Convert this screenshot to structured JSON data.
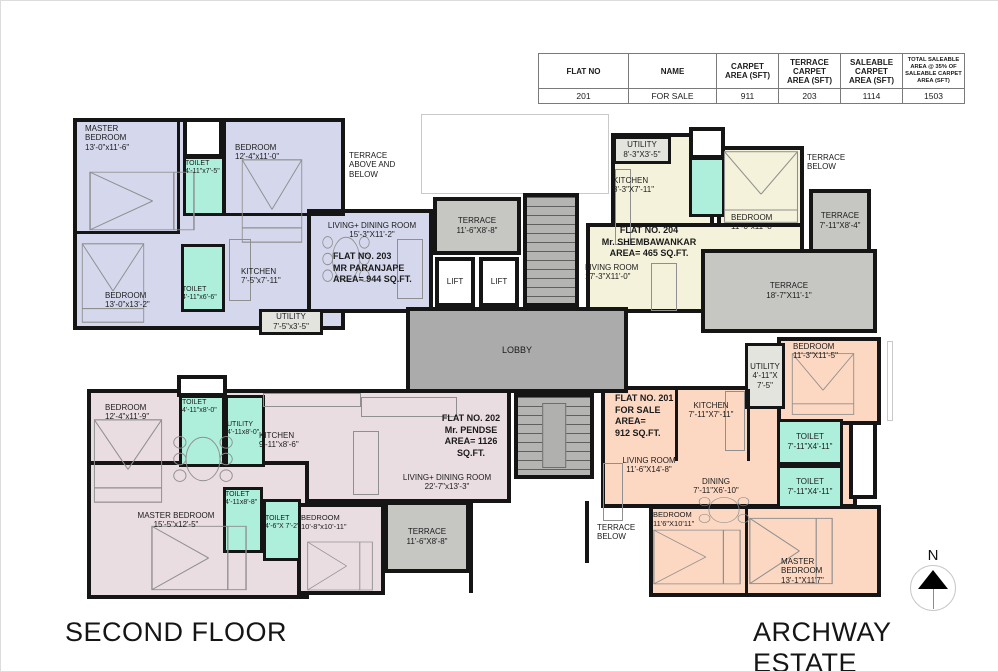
{
  "table": {
    "headers": [
      "FLAT NO",
      "NAME",
      "CARPET AREA (SFT)",
      "TERRACE CARPET AREA (SFT)",
      "SALEABLE CARPET AREA (SFT)",
      "TOTAL SALEABLE AREA @ 35% OF SALEABLE CARPET AREA (SFT)"
    ],
    "row": [
      "201",
      "FOR SALE",
      "911",
      "203",
      "1114",
      "1503"
    ]
  },
  "flats": {
    "f201": {
      "lines": [
        "FLAT NO. 201",
        "FOR SALE",
        "AREA=",
        "912 SQ.FT."
      ]
    },
    "f202": {
      "lines": [
        "FLAT NO. 202",
        "Mr. PENDSE",
        "AREA= 1126",
        "SQ.FT."
      ]
    },
    "f203": {
      "lines": [
        "FLAT NO. 203",
        "MR PARANJAPE",
        "AREA= 944 SQ.FT."
      ]
    },
    "f204": {
      "lines": [
        "FLAT NO. 204",
        "Mr. SHEMBAWANKAR",
        "AREA= 465 SQ.FT."
      ]
    }
  },
  "rooms": {
    "r203_master": {
      "name": "MASTER BEDROOM",
      "dims": "13'-0\"x11'-6\""
    },
    "r203_bed2": {
      "name": "BEDROOM",
      "dims": "12'-4\"x11'-0\""
    },
    "r203_bed3": {
      "name": "BEDROOM",
      "dims": "13'-0\"x13'-2\""
    },
    "r203_toilet1": {
      "name": "TOILET",
      "dims": "4'-11\"x7'-5\""
    },
    "r203_toilet2": {
      "name": "TOILET",
      "dims": "4'-11\"x6'-6\""
    },
    "r203_kitchen": {
      "name": "KITCHEN",
      "dims": "7'-5\"x7'-11\""
    },
    "r203_utility": {
      "name": "UTILITY",
      "dims": "7'-5\"x3'-5\""
    },
    "r203_living": {
      "name": "LIVING+ DINING ROOM",
      "dims": "15'-3\"X11'-2\""
    },
    "r204_utility": {
      "name": "UTILITY",
      "dims": "8'-3\"X3'-5\""
    },
    "r204_kitchen": {
      "name": "KITCHEN",
      "dims": "8'-3\"X7'-11\""
    },
    "r204_bed": {
      "name": "BEDROOM",
      "dims": "11'-0\"x11'-8\""
    },
    "r204_living": {
      "name": "LIVING ROOM",
      "dims": "17'-3\"X11'-0\""
    },
    "r201_kitchen": {
      "name": "KITCHEN",
      "dims": "7'-11\"X7'-11\""
    },
    "r201_utility": {
      "name": "UTILITY",
      "dims": "4'-11\"X 7'-5\""
    },
    "r201_bed1": {
      "name": "BEDROOM",
      "dims": "11'-3\"X11'-5\""
    },
    "r201_toilet1": {
      "name": "TOILET",
      "dims": "7'-11\"X4'-11\""
    },
    "r201_toilet2": {
      "name": "TOILET",
      "dims": "7'-11\"X4'-11\""
    },
    "r201_living": {
      "name": "LIVING ROOM",
      "dims": "11'-6\"X14'-8\""
    },
    "r201_dining": {
      "name": "DINING",
      "dims": "7'-11\"X6'-10\""
    },
    "r201_bed2": {
      "name": "BEDROOM",
      "dims": "11'6\"X10'11\""
    },
    "r201_master": {
      "name": "MASTER BEDROOM",
      "dims": "13'-1\"X11'7\""
    },
    "r202_bed1": {
      "name": "BEDROOM",
      "dims": "12'-4\"x11'-9\""
    },
    "r202_toilet1": {
      "name": "TOILET",
      "dims": "4'-11\"x8'-0\""
    },
    "r202_utility": {
      "name": "UTILITY",
      "dims": "4'-11x8'-0\""
    },
    "r202_kitchen": {
      "name": "KITCHEN",
      "dims": "9'-11\"x8'-6\""
    },
    "r202_master": {
      "name": "MASTER BEDROOM",
      "dims": "15'-5\"x12'-5\""
    },
    "r202_toilet2": {
      "name": "TOILET",
      "dims": "4'-11x8'-8\""
    },
    "r202_toilet3": {
      "name": "TOILET",
      "dims": "4'-6\"X 7'-2\""
    },
    "r202_bed3": {
      "name": "BEDROOM",
      "dims": "10'-8\"x10'-11\""
    },
    "r202_living": {
      "name": "LIVING+ DINING ROOM",
      "dims": "22'-7\"x13'-3\""
    },
    "terrace_center": {
      "name": "TERRACE",
      "dims": "11'-6\"X8'-8\""
    },
    "terrace_202": {
      "name": "TERRACE",
      "dims": "11'-6\"X8'-8\""
    },
    "terrace_204_small": {
      "name": "TERRACE",
      "dims": "7'-11\"X8'-4\""
    },
    "terrace_204_big": {
      "name": "TERRACE",
      "dims": "18'-7\"X11'-1\""
    },
    "terrace_above_below": {
      "line1": "TERRACE",
      "line2": "ABOVE AND",
      "line3": "BELOW"
    },
    "terrace_below": {
      "line1": "TERRACE",
      "line2": "BELOW"
    },
    "lobby": {
      "name": "LOBBY"
    },
    "lift": {
      "name": "LIFT"
    }
  },
  "footer": {
    "floor": "SECOND FLOOR",
    "project": "ARCHWAY ESTATE"
  },
  "compass": {
    "label": "N"
  },
  "colors": {
    "flat_201_fill": "#fcd8c3",
    "flat_202_fill": "#eadde2",
    "flat_203_fill": "#d5d8ec",
    "flat_204_fill": "#f4f2db",
    "toilet_fill": "#aeefdb",
    "terrace_fill": "#c6c6c3",
    "lobby_fill": "#ababab",
    "wall_color": "#151515"
  }
}
